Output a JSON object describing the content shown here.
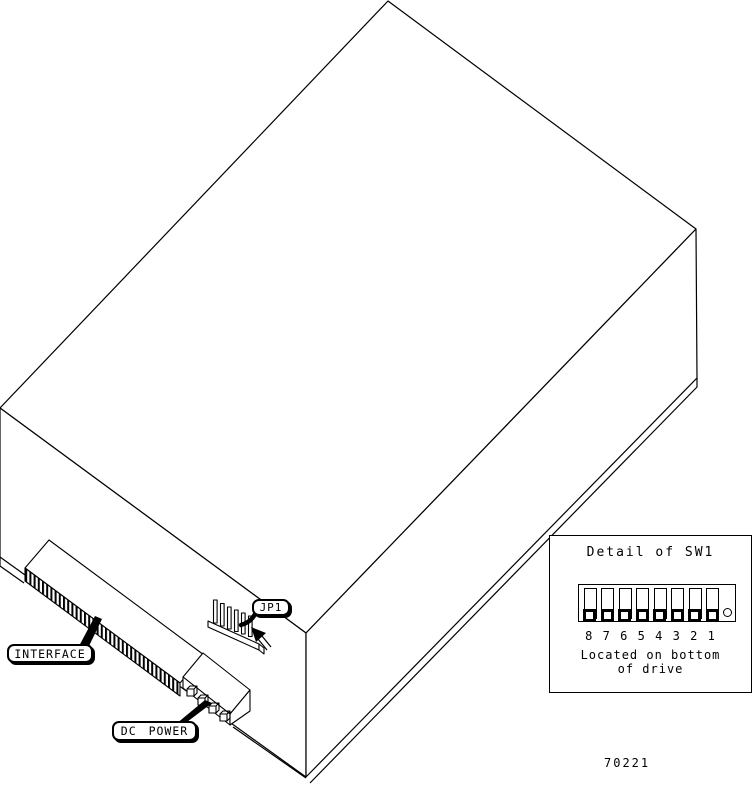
{
  "callouts": {
    "interface": "INTERFACE",
    "dc_power": "DC POWER",
    "jp1": "JP1"
  },
  "detail_panel": {
    "title": "Detail of SW1",
    "switch_numbers": [
      "8",
      "7",
      "6",
      "5",
      "4",
      "3",
      "2",
      "1"
    ],
    "switch_count": 8,
    "switches_shown_position": "down",
    "caption_line1": "Located on bottom",
    "caption_line2": "of drive"
  },
  "figure_number": "70221",
  "colors": {
    "line": "#000000",
    "background": "#ffffff"
  }
}
